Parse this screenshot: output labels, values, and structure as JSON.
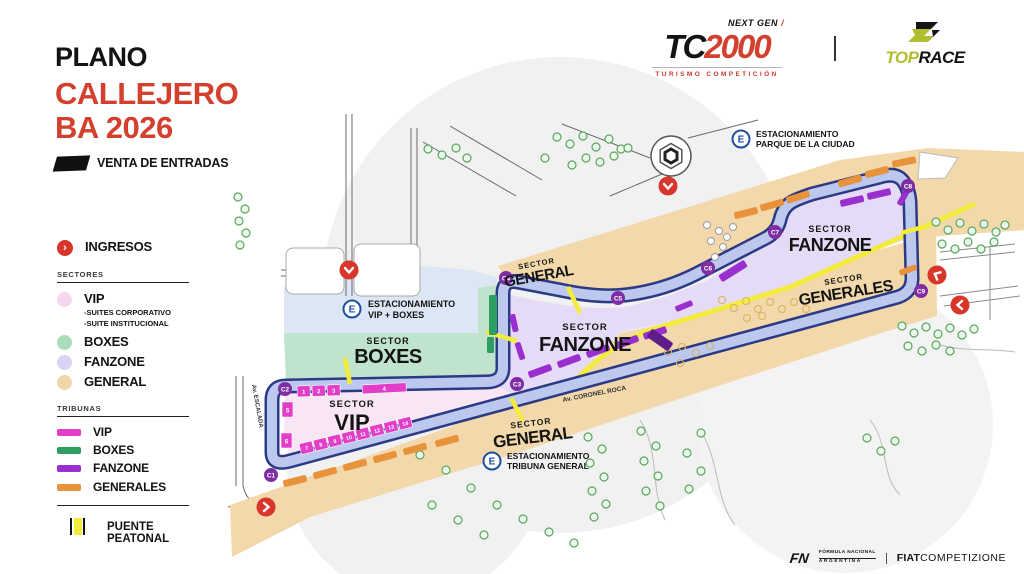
{
  "header": {
    "title_line1": "PLANO",
    "title_line2": "CALLEJERO",
    "title_line3": "BA 2026",
    "tickets_label": "VENTA DE ENTRADAS"
  },
  "brand": {
    "tc2000": {
      "next_gen": "NEXT GEN",
      "slash": "/",
      "name_tc": "TC",
      "name_2000": "2000",
      "subtitle": "TURISMO COMPETICIÓN"
    },
    "toprace": {
      "top": "TOP",
      "race": "RACE"
    }
  },
  "legend": {
    "ingresos_label": "INGRESOS",
    "sectores_title": "SECTORES",
    "sectores": [
      {
        "label": "VIP",
        "color": "#f4d7ef",
        "note1": "-SUITES CORPORATIVO",
        "note2": "-SUITE INSTITUCIONAL"
      },
      {
        "label": "BOXES",
        "color": "#abdcbd"
      },
      {
        "label": "FANZONE",
        "color": "#dcd2f4"
      },
      {
        "label": "GENERAL",
        "color": "#f1d7a8"
      }
    ],
    "tribunas_title": "TRIBUNAS",
    "tribunas": [
      {
        "label": "VIP",
        "color": "#e23ec8"
      },
      {
        "label": "BOXES",
        "color": "#2f9e63"
      },
      {
        "label": "FANZONE",
        "color": "#9a2fd0"
      },
      {
        "label": "GENERALES",
        "color": "#e8923c"
      }
    ],
    "puente_label": "PUENTE PEATONAL"
  },
  "map": {
    "sectors": {
      "boxes": {
        "kicker": "SECTOR",
        "name": "BOXES"
      },
      "vip": {
        "kicker": "SECTOR",
        "name": "VIP"
      },
      "fanzone_mid": {
        "kicker": "SECTOR",
        "name": "FANZONE"
      },
      "fanzone_right": {
        "kicker": "SECTOR",
        "name": "FANZONE"
      },
      "general_top": {
        "kicker": "SECTOR",
        "name": "GENERAL"
      },
      "general_bottom": {
        "kicker": "SECTOR",
        "name": "GENERAL"
      },
      "generales": {
        "kicker": "SECTOR",
        "name": "GENERALES"
      }
    },
    "parkings": {
      "parque": {
        "icon": "E",
        "line1": "ESTACIONAMIENTO",
        "line2": "PARQUE DE LA CIUDAD"
      },
      "vip_boxes": {
        "icon": "E",
        "line1": "ESTACIONAMIENTO",
        "line2": "VIP + BOXES"
      },
      "tribuna_general": {
        "icon": "E",
        "line1": "ESTACIONAMIENTO",
        "line2": "TRIBUNA GENERAL"
      }
    },
    "streets": {
      "escalada": "Av. ESCALADA",
      "coronel_roca": "Av. CORONEL ROCA"
    },
    "curves": [
      "C1",
      "C2",
      "C3",
      "C4",
      "C5",
      "C6",
      "C7",
      "C8",
      "C9"
    ],
    "vip_tribunes": [
      "1",
      "2",
      "3",
      "4",
      "5",
      "6",
      "7",
      "8",
      "9",
      "10",
      "11",
      "12",
      "13",
      "14"
    ],
    "colors": {
      "track_border": "#2c3a85",
      "track_fill": "#bcc8ee",
      "vip_area": "#f8e6f5",
      "boxes_area": "#bfe3cc",
      "fanzone_area": "#e5dbf6",
      "general_area": "#f2d8ab",
      "parking_area": "#dce6f5",
      "puente": "#f3ec3c",
      "ingreso": "#d8352b",
      "curve_badge": "#7e2da5"
    }
  },
  "footer": {
    "fn": "FN",
    "line1": "FÓRMULA NACIONAL",
    "line2": "ARGENTINA",
    "fiat": "FIAT",
    "competizione": "COMPETIZIONE"
  }
}
